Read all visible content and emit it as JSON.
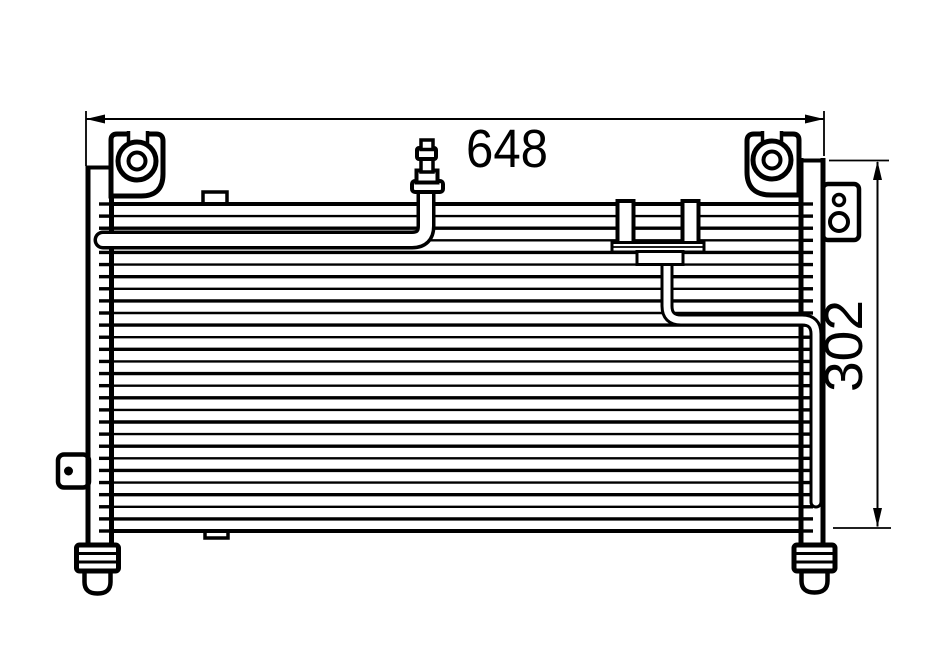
{
  "drawing": {
    "type": "technical-line-drawing",
    "subject": "automotive A/C condenser, front elevation",
    "background_color": "#ffffff",
    "line_color": "#000000",
    "dimensions": {
      "width": {
        "label": "648",
        "orientation": "horizontal",
        "arrow_style": "filled-outward"
      },
      "height": {
        "label": "302",
        "orientation": "vertical-rotated-90ccw",
        "arrow_style": "filled-outward"
      }
    },
    "parts": [
      "left-header-tank",
      "right-header-tank",
      "core-fins",
      "tube-ends",
      "mounting-bracket-top-left",
      "mounting-bracket-top-right",
      "service-valve",
      "inlet-pipe",
      "liquid-pipe",
      "pipe-clamp-assembly",
      "side-bracket-right",
      "side-tab-left",
      "top-tab",
      "bottom-tab",
      "bottom-fitting-left",
      "bottom-fitting-right"
    ]
  }
}
